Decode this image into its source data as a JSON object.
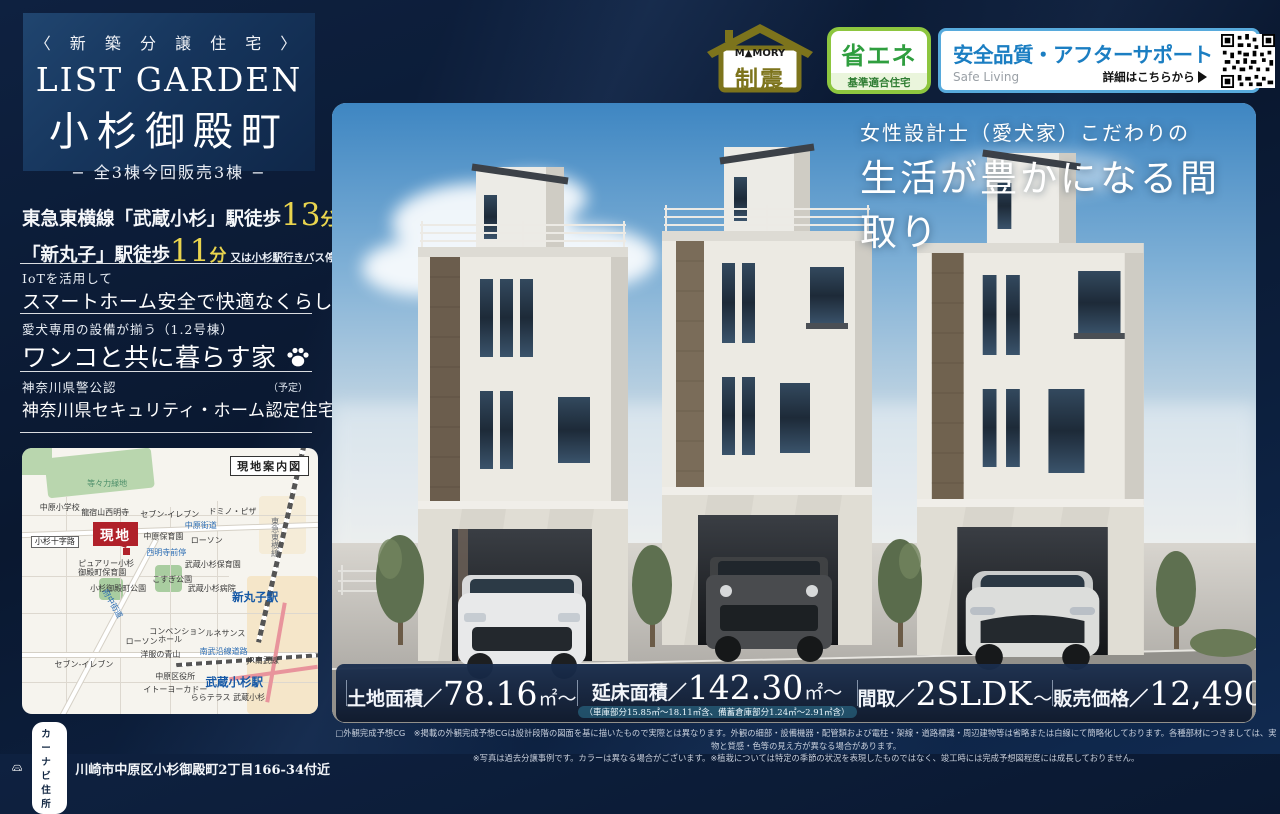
{
  "sidebar": {
    "category": "〈 新 築 分 譲 住 宅 〉",
    "brand": "LIST GARDEN",
    "property_name": "小杉御殿町",
    "units": "− 全3棟今回販売3棟 −",
    "access": {
      "line1_prefix": "東急東横線「武蔵小杉」駅徒歩",
      "line1_minutes": "13",
      "line1_suffix": "分",
      "line2_prefix": "「新丸子」駅徒歩",
      "line2_minutes": "11",
      "line2_suffix": "分",
      "line2_note": "又は小杉駅行きバス停徒歩1分利用可能"
    },
    "features": [
      {
        "lead": "IoTを活用して",
        "title": "スマートホーム安全で快適なくらし"
      },
      {
        "lead": "愛犬専用の設備が揃う（1.2号棟）",
        "title": "ワンコと共に暮らす家"
      },
      {
        "lead": "神奈川県警公認",
        "lead_note": "（予定）",
        "title": "神奈川県セキュリティ・ホーム認定住宅"
      }
    ],
    "map": {
      "title": "現地案内図",
      "site_label": "現地",
      "labels": [
        {
          "text": "等々力緑地",
          "x": 22,
          "y": 12,
          "t": "green"
        },
        {
          "text": "中原小学校",
          "x": 6,
          "y": 21,
          "t": "place"
        },
        {
          "text": "龍宿山西明寺",
          "x": 20,
          "y": 23,
          "t": "place"
        },
        {
          "text": "セブン-イレブン",
          "x": 40,
          "y": 23.5,
          "t": "place"
        },
        {
          "text": "ドミノ・ピザ",
          "x": 63,
          "y": 22.5,
          "t": "place"
        },
        {
          "text": "中原街道",
          "x": 55,
          "y": 28,
          "t": "road"
        },
        {
          "text": "小杉十字路",
          "x": 3,
          "y": 33,
          "t": "boxed"
        },
        {
          "text": "中原保育園",
          "x": 41,
          "y": 32,
          "t": "place"
        },
        {
          "text": "ローソン",
          "x": 57,
          "y": 33.5,
          "t": "place"
        },
        {
          "text": "西明寺前停",
          "x": 42,
          "y": 38,
          "t": "road"
        },
        {
          "text": "ピュアリー小杉",
          "x": 19,
          "y": 42,
          "t": "place"
        },
        {
          "text": "御殿町保育園",
          "x": 19,
          "y": 45.5,
          "t": "place"
        },
        {
          "text": "武蔵小杉保育園",
          "x": 55,
          "y": 42.5,
          "t": "place"
        },
        {
          "text": "こすぎ公園",
          "x": 44,
          "y": 48,
          "t": "place"
        },
        {
          "text": "小杉御殿町公園",
          "x": 23,
          "y": 51.5,
          "t": "place"
        },
        {
          "text": "武蔵小杉病院",
          "x": 56,
          "y": 51.5,
          "t": "place"
        },
        {
          "text": "新丸子駅",
          "x": 71,
          "y": 54,
          "t": "station"
        },
        {
          "text": "東急東横線",
          "x": 84,
          "y": 26,
          "t": "vert"
        },
        {
          "text": "府中街道",
          "x": 25,
          "y": 57,
          "t": "rot"
        },
        {
          "text": "コンベンション",
          "x": 43,
          "y": 67.5,
          "t": "place"
        },
        {
          "text": "ホール",
          "x": 46,
          "y": 70.5,
          "t": "place"
        },
        {
          "text": "ルネサンス",
          "x": 62,
          "y": 68.5,
          "t": "place"
        },
        {
          "text": "ローソン",
          "x": 35,
          "y": 71.5,
          "t": "place"
        },
        {
          "text": "洋服の青山",
          "x": 40,
          "y": 76.5,
          "t": "place"
        },
        {
          "text": "南武沿線道路",
          "x": 60,
          "y": 75,
          "t": "road"
        },
        {
          "text": "JR南武線",
          "x": 76,
          "y": 78.5,
          "t": "place"
        },
        {
          "text": "セブン-イレブン",
          "x": 11,
          "y": 80,
          "t": "place"
        },
        {
          "text": "中原区役所",
          "x": 45,
          "y": 84.5,
          "t": "place"
        },
        {
          "text": "武蔵小杉駅",
          "x": 62,
          "y": 86,
          "t": "station"
        },
        {
          "text": "イトーヨーカドー",
          "x": 41,
          "y": 89.5,
          "t": "place"
        },
        {
          "text": "ららテラス 武蔵小杉",
          "x": 57,
          "y": 92.5,
          "t": "place"
        }
      ]
    },
    "car_nav": {
      "label": "カーナビ住所",
      "address": "川崎市中原区小杉御殿町2丁目166-34付近"
    }
  },
  "badges": {
    "seismic": {
      "logo": "M▲MORY",
      "label": "制震"
    },
    "eco": {
      "label": "省エネ",
      "sub": "基準適合住宅"
    },
    "safety": {
      "title": "安全品質・アフターサポート",
      "sub": "Safe Living",
      "cta": "詳細はこちらから"
    }
  },
  "hero": {
    "catch_lead": "女性設計士（愛犬家）こだわりの",
    "catch_main": "生活が豊かになる間取り"
  },
  "specs": {
    "items": [
      {
        "label": "土地面積／",
        "value": "78.16",
        "unit": "㎡～"
      },
      {
        "label": "延床面積／",
        "value": "142.30",
        "unit": "㎡～",
        "note": "（車庫部分15.85㎡～18.11㎡含、備蓄倉庫部分1.24㎡～2.91㎡含）"
      },
      {
        "label": "間取／",
        "value": "2SLDK",
        "unit": "～"
      },
      {
        "label": "販売価格／",
        "value": "12,490",
        "unit": "万円～",
        "sup": "（税込）"
      }
    ]
  },
  "disclaimer": {
    "line1": "□外観完成予想CG　※掲載の外観完成予想CGは設計段階の図面を基に描いたもので実際とは異なります。外観の細部・設備機器・配管類および電柱・架線・道路標識・周辺建物等は省略または白線にて簡略化しております。各種部材につきましては、実物と質感・色等の見え方が異なる場合があります。",
    "line2": "※写真は過去分譲事例です。カラーは異なる場合がございます。※植栽については特定の季節の状況を表現したものではなく、竣工時には完成予想図程度には成長しておりません。"
  },
  "colors": {
    "bg_navy": "#0c1f3d",
    "accent_yellow": "#e9d44e",
    "site_red": "#b0212a",
    "station_blue": "#1558a6",
    "seismic_olive": "#7d741c",
    "eco_green": "#2f9e3f",
    "safety_blue": "#1b7ec2"
  }
}
